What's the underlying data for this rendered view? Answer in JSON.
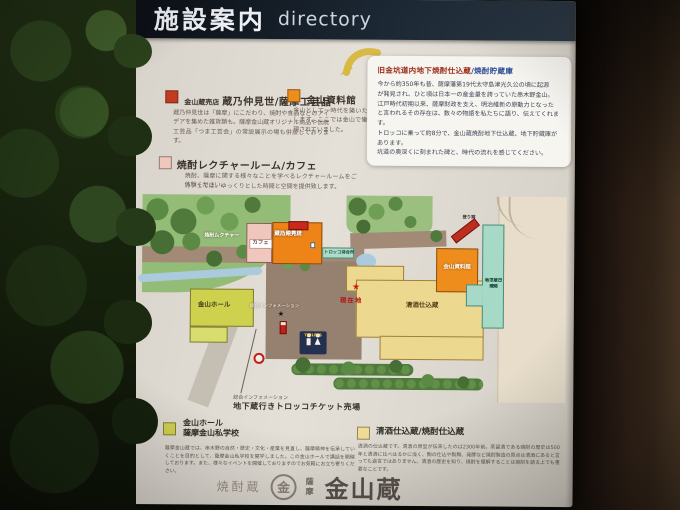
{
  "header": {
    "title_ja": "施設案内",
    "title_en": "directory"
  },
  "info_box": {
    "title_main": "旧金坑道内地下焼酎仕込蔵",
    "title_sub": "/焼酎貯蔵庫",
    "body": [
      "今から約350年も昔、薩摩藩第19代太守島津光久公の頃に起源",
      "が発見され、ひと頃は日本一の産金量を誇っていた串木野金山。",
      "江戸時代初期以来、薩摩財政を支え、明治維新の原動力となった",
      "と言われるその存在は、数々の物語を私たちに語り、伝えてくれます。",
      "トロッコに乗って約8分で、金山蔵焼酎地下仕込蔵、地下貯蔵庫が",
      "あります。",
      "坑道の奥深くに刻まれた碑と、時代の流れを感じてください。"
    ]
  },
  "legend_top": {
    "shop": {
      "prefix": "金山蔵売店",
      "title": "蔵乃仲見世/薩摩工芸品",
      "desc": "蔵乃仲見世は「薩摩」にこだわり、焼酎や食品などのアイデアを集めた雑貨類も。薩摩金山蔵オリジナル商品や伝統工芸品「つま工芸会」の常設展示の場も併設しております。"
    },
    "museum": {
      "title": "金山資料館",
      "desc": "金山として一時代を築いたその歴史を紹介します。ここでは金山で働く人達の姿が再現されていました。"
    },
    "lecture": {
      "title": "焼酎レクチャールーム/カフェ",
      "desc_1": "焼酎、薩摩に関する様々なことを学べるレクチャールームをご体験ください。",
      "desc_2": "カフェでは、ゆっくりとした時間と空間を提供致します。"
    }
  },
  "map": {
    "cafe_label": "カフェ",
    "lecture_label_1": "焼酎レクチャー",
    "lecture_label_2": "ルーム",
    "shop_label_1": "金山蔵売店",
    "shop_label_2": "蔵乃仲見世",
    "trolley_wait_label": "トロッコ待合所",
    "hall_label": "金山ホール",
    "museum_label": "金山資料館",
    "kiln_label": "登り窯",
    "trolley_platform_label_1": "地下蔵行き",
    "trolley_platform_label_2": "トロッコ乗場",
    "sake_label": "清酒仕込蔵",
    "you_are_here": "現在地",
    "you_are_here_star": "★",
    "info_label": "総合インフォメーション",
    "info_star": "★",
    "toilets_label": "TOILETS",
    "ticket_caption_small": "総合インフォメーション",
    "ticket_caption": "地下蔵行きトロッコチケット売場"
  },
  "legend_bottom": {
    "hall": {
      "title_1": "金山ホール",
      "title_2": "薩摩金山私学校",
      "desc": "薩摩金山蔵では、串木野の自然・歴史・文化・産業を見直し、薩摩精神を伝承していくことを目的として、薩摩金山私学校を開学しました。この金山ホールで講話を開催しております。また、様々なイベントを開催しておりますのでお気軽にお立ち寄りください。"
    },
    "sake": {
      "title": "清酒仕込蔵/焼酎仕込蔵",
      "desc": "清酒の仕込蔵です。清酒の原型が伝来したのは2300年前。蒸留酒である焼酎の歴史は500年と清酒に比べはるかに浅く、麹の仕込や製麹、発酵など焼酎製造の原点は清酒にあると言っても過言ではありません。清酒の歴史を知り、焼酎を理解することは焼酎を語る上でも重要なことです。"
    }
  },
  "footer_logo": {
    "left": "焼酎蔵",
    "mark": "金",
    "brand_small": "薩摩",
    "brand": "金山蔵"
  },
  "colors": {
    "header_bg": "#16212e",
    "shop_red": "#c23a20",
    "roof_red": "#c9281a",
    "museum_orange": "#ee8c1c",
    "lecture_pink": "#efc7bd",
    "hall_yellow_green": "#ced14e",
    "sake_cream": "#ecd98f",
    "trolley_teal": "#a7d9c7",
    "map_green": "#93bc77",
    "path_brown": "#a28a77",
    "star_red": "#d01818",
    "toilets_navy": "#23304f"
  }
}
